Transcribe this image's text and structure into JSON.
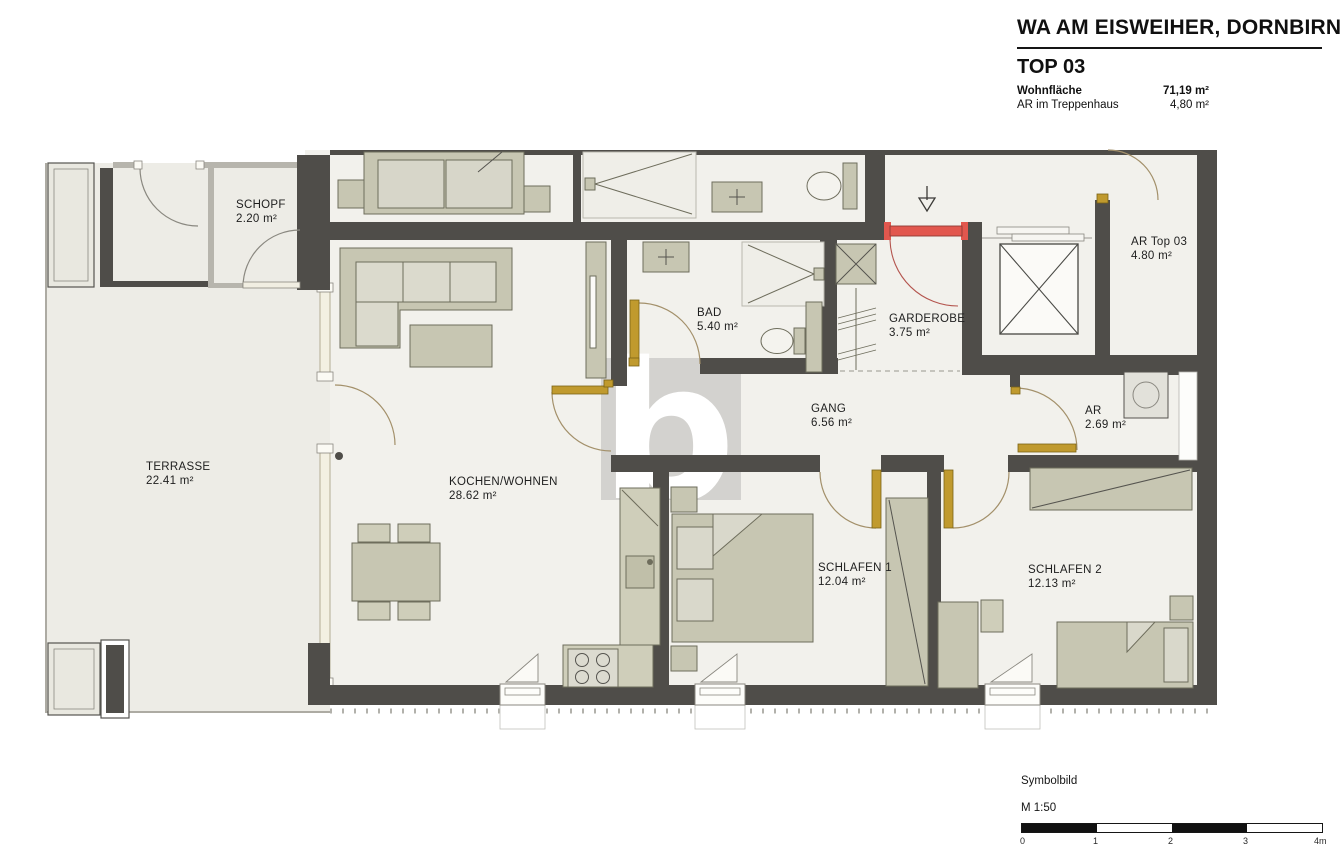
{
  "header": {
    "project_title": "WA AM EISWEIHER, DORNBIRN",
    "unit_title": "TOP 03",
    "area_rows": [
      {
        "label": "Wohnfläche",
        "value": "71,19 m²"
      },
      {
        "label": "AR im Treppenhaus",
        "value": "4,80 m²"
      }
    ]
  },
  "watermark": {
    "letter": "b"
  },
  "rooms": {
    "schopf": {
      "name": "SCHOPF",
      "area": "2.20 m²"
    },
    "terrasse": {
      "name": "TERRASSE",
      "area": "22.41 m²"
    },
    "kochen_wohnen": {
      "name": "KOCHEN/WOHNEN",
      "area": "28.62 m²"
    },
    "bad": {
      "name": "BAD",
      "area": "5.40 m²"
    },
    "gang": {
      "name": "GANG",
      "area": "6.56 m²"
    },
    "garderobe": {
      "name": "GARDEROBE",
      "area": "3.75 m²"
    },
    "ar_top_03": {
      "name": "AR Top 03",
      "area": "4.80 m²"
    },
    "ar": {
      "name": "AR",
      "area": "2.69 m²"
    },
    "schlafen_1": {
      "name": "SCHLAFEN 1",
      "area": "12.04 m²"
    },
    "schlafen_2": {
      "name": "SCHLAFEN 2",
      "area": "12.13 m²"
    }
  },
  "footer": {
    "note": "Symbolbild",
    "scale_label": "M 1:50",
    "scale_ticks": [
      "0",
      "1",
      "2",
      "3",
      "4m"
    ]
  },
  "colors": {
    "wall_dark": "#4f4d49",
    "furniture_olive": "#c7c6b2",
    "entry_door_red": "#e2574e",
    "interior_door_gold": "#c09a2e",
    "watermark_gray": "#d3d2cf"
  }
}
